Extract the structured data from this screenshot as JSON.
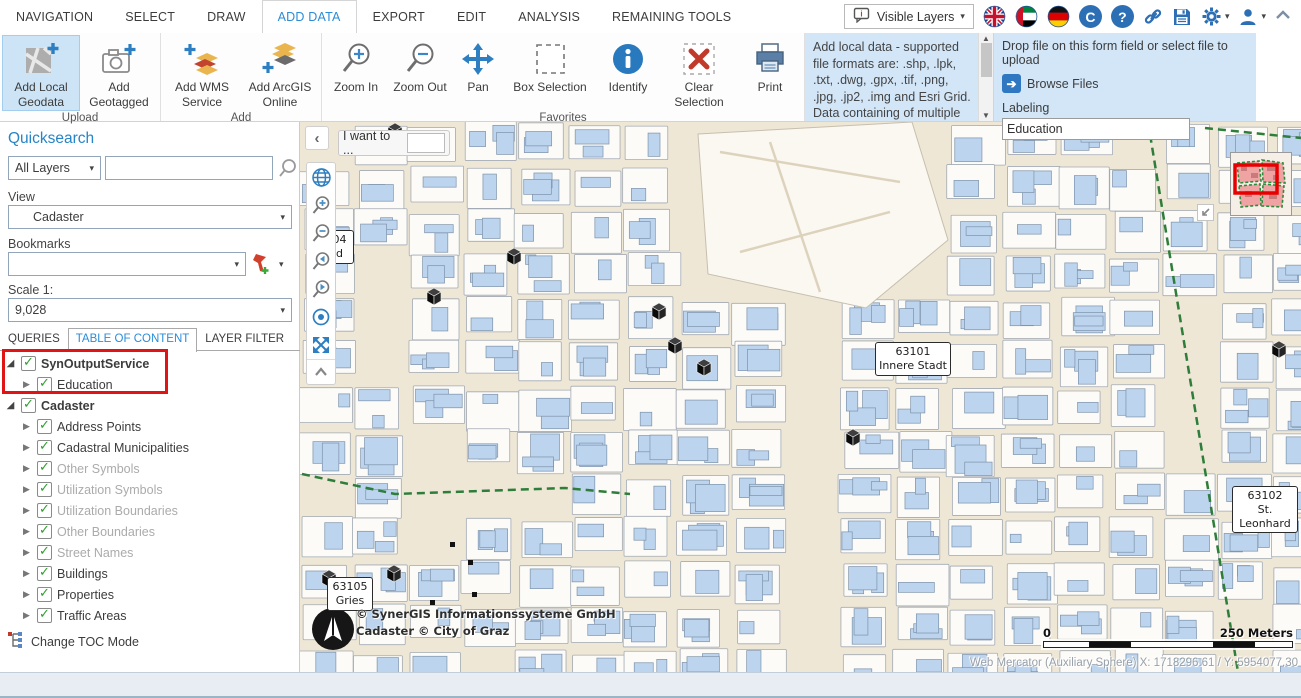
{
  "menu": {
    "items": [
      "NAVIGATION",
      "SELECT",
      "DRAW",
      "ADD DATA",
      "EXPORT",
      "EDIT",
      "ANALYSIS",
      "REMAINING TOOLS"
    ],
    "active": "ADD DATA"
  },
  "topbar": {
    "visible_layers": "Visible Layers",
    "icons": [
      "legend-bubble-icon",
      "flag-uk-icon",
      "flag-uae-icon",
      "flag-germany-icon",
      "copyright-icon",
      "help-icon",
      "link-icon",
      "save-icon",
      "gear-icon",
      "user-icon",
      "collapse-chevron-icon"
    ]
  },
  "ribbon": {
    "groups": [
      {
        "label": "Upload",
        "tools": [
          "Add Local Geodata",
          "Add Geotagged"
        ]
      },
      {
        "label": "Add",
        "tools": [
          "Add WMS Service",
          "Add ArcGIS Online"
        ]
      },
      {
        "label": "Favorites",
        "tools": [
          "Zoom In",
          "Zoom Out",
          "Pan",
          "Box Selection",
          "Identify",
          "Clear Selection",
          "Print"
        ]
      }
    ],
    "selected_tool": "Add Local Geodata"
  },
  "info_panel": {
    "text": "Add local data - supported file formats are: .shp, .lpk, .txt, .dwg, .gpx, .tif, .png, .jpg, .jp2, .img and Esri Grid. Data containing of multiple"
  },
  "dropzone": {
    "instruction": "Drop file on this form field or select file to upload",
    "browse_label": "Browse Files",
    "labeling_label": "Labeling",
    "labeling_value": "Education"
  },
  "sidebar": {
    "quicksearch_title": "Quicksearch",
    "layers_select_value": "All Layers",
    "search_value": "",
    "view_label": "View",
    "view_value": "Cadaster",
    "bookmarks_label": "Bookmarks",
    "bookmarks_value": "",
    "scale_label": "Scale 1:",
    "scale_value": "9,028",
    "tabs": [
      {
        "label": "QUERIES",
        "active": false
      },
      {
        "label": "TABLE OF CONTENT",
        "active": true
      },
      {
        "label": "LAYER FILTER",
        "active": false
      }
    ],
    "tree": [
      {
        "label": "SynOutputService",
        "bold": true,
        "expanded": true,
        "checked": true
      },
      {
        "label": "Education",
        "checked": true
      },
      {
        "label": "Cadaster",
        "bold": true,
        "expanded": true,
        "checked": true
      },
      {
        "label": "Address Points",
        "checked": true
      },
      {
        "label": "Cadastral Municipalities",
        "checked": true
      },
      {
        "label": "Other Symbols",
        "checked": true,
        "gray": true
      },
      {
        "label": "Utilization Symbols",
        "checked": true,
        "gray": true
      },
      {
        "label": "Utilization Boundaries",
        "checked": true,
        "gray": true
      },
      {
        "label": "Other Boundaries",
        "checked": true,
        "gray": true
      },
      {
        "label": "Street Names",
        "checked": true,
        "gray": true
      },
      {
        "label": "Buildings",
        "checked": true
      },
      {
        "label": "Properties",
        "checked": true
      },
      {
        "label": "Traffic Areas",
        "checked": true
      }
    ],
    "change_toc_label": "Change TOC Mode"
  },
  "map": {
    "i_want_to": "I want to ...",
    "labels": [
      {
        "code": "63101",
        "name": "Innere Stadt"
      },
      {
        "code": "63102",
        "name": "St. Leonhard"
      },
      {
        "code": "63105",
        "name": "Gries"
      },
      {
        "code": "104",
        "name": "nd"
      }
    ],
    "attribution_line1": "© SynerGIS Informationssysteme GmbH",
    "attribution_line2": "Cadaster © City of Graz",
    "scalebar_start": "0",
    "scalebar_end": "250 Meters",
    "coordinates": "Web Mercator (Auxiliary Sphere) X: 1718296.61 / Y: 5954077.30"
  },
  "colors": {
    "accent_blue": "#2b8cd8",
    "panel_blue": "#d2e6f8",
    "selection_red": "#e01414",
    "building_blue": "#bcd4ee",
    "map_beige": "#efe7d6",
    "boundary_green": "#2e7d3a"
  }
}
